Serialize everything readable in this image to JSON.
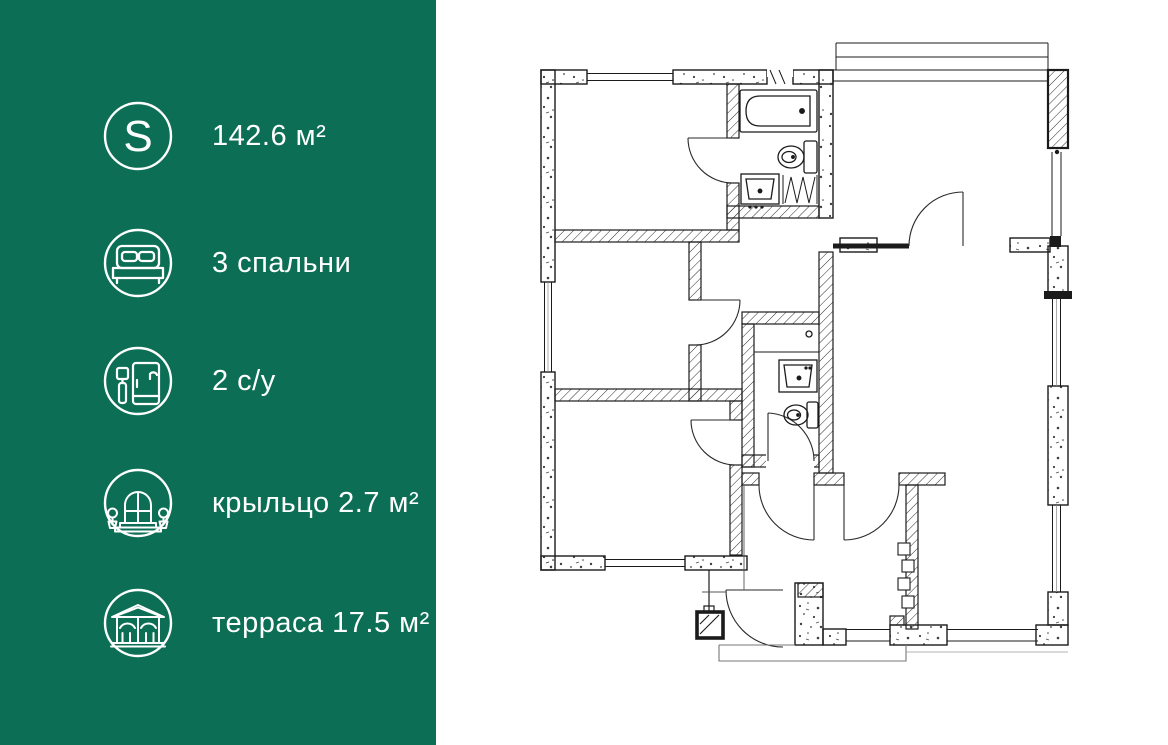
{
  "app": {
    "title": "apartment floor plan card"
  },
  "colors": {
    "sidebar_bg": "#0b6e55",
    "text": "#ffffff",
    "plan_line": "#1b1b1b"
  },
  "sidebar": {
    "area_symbol": "S",
    "items": [
      {
        "icon": "area-icon",
        "label": "142.6 м²"
      },
      {
        "icon": "bedrooms-icon",
        "label": "3 спальни"
      },
      {
        "icon": "bathrooms-icon",
        "label": "2 с/у"
      },
      {
        "icon": "porch-icon",
        "label": "крыльцо 2.7 м²"
      },
      {
        "icon": "terrace-icon",
        "label": "терраса 17.5 м²"
      }
    ]
  }
}
